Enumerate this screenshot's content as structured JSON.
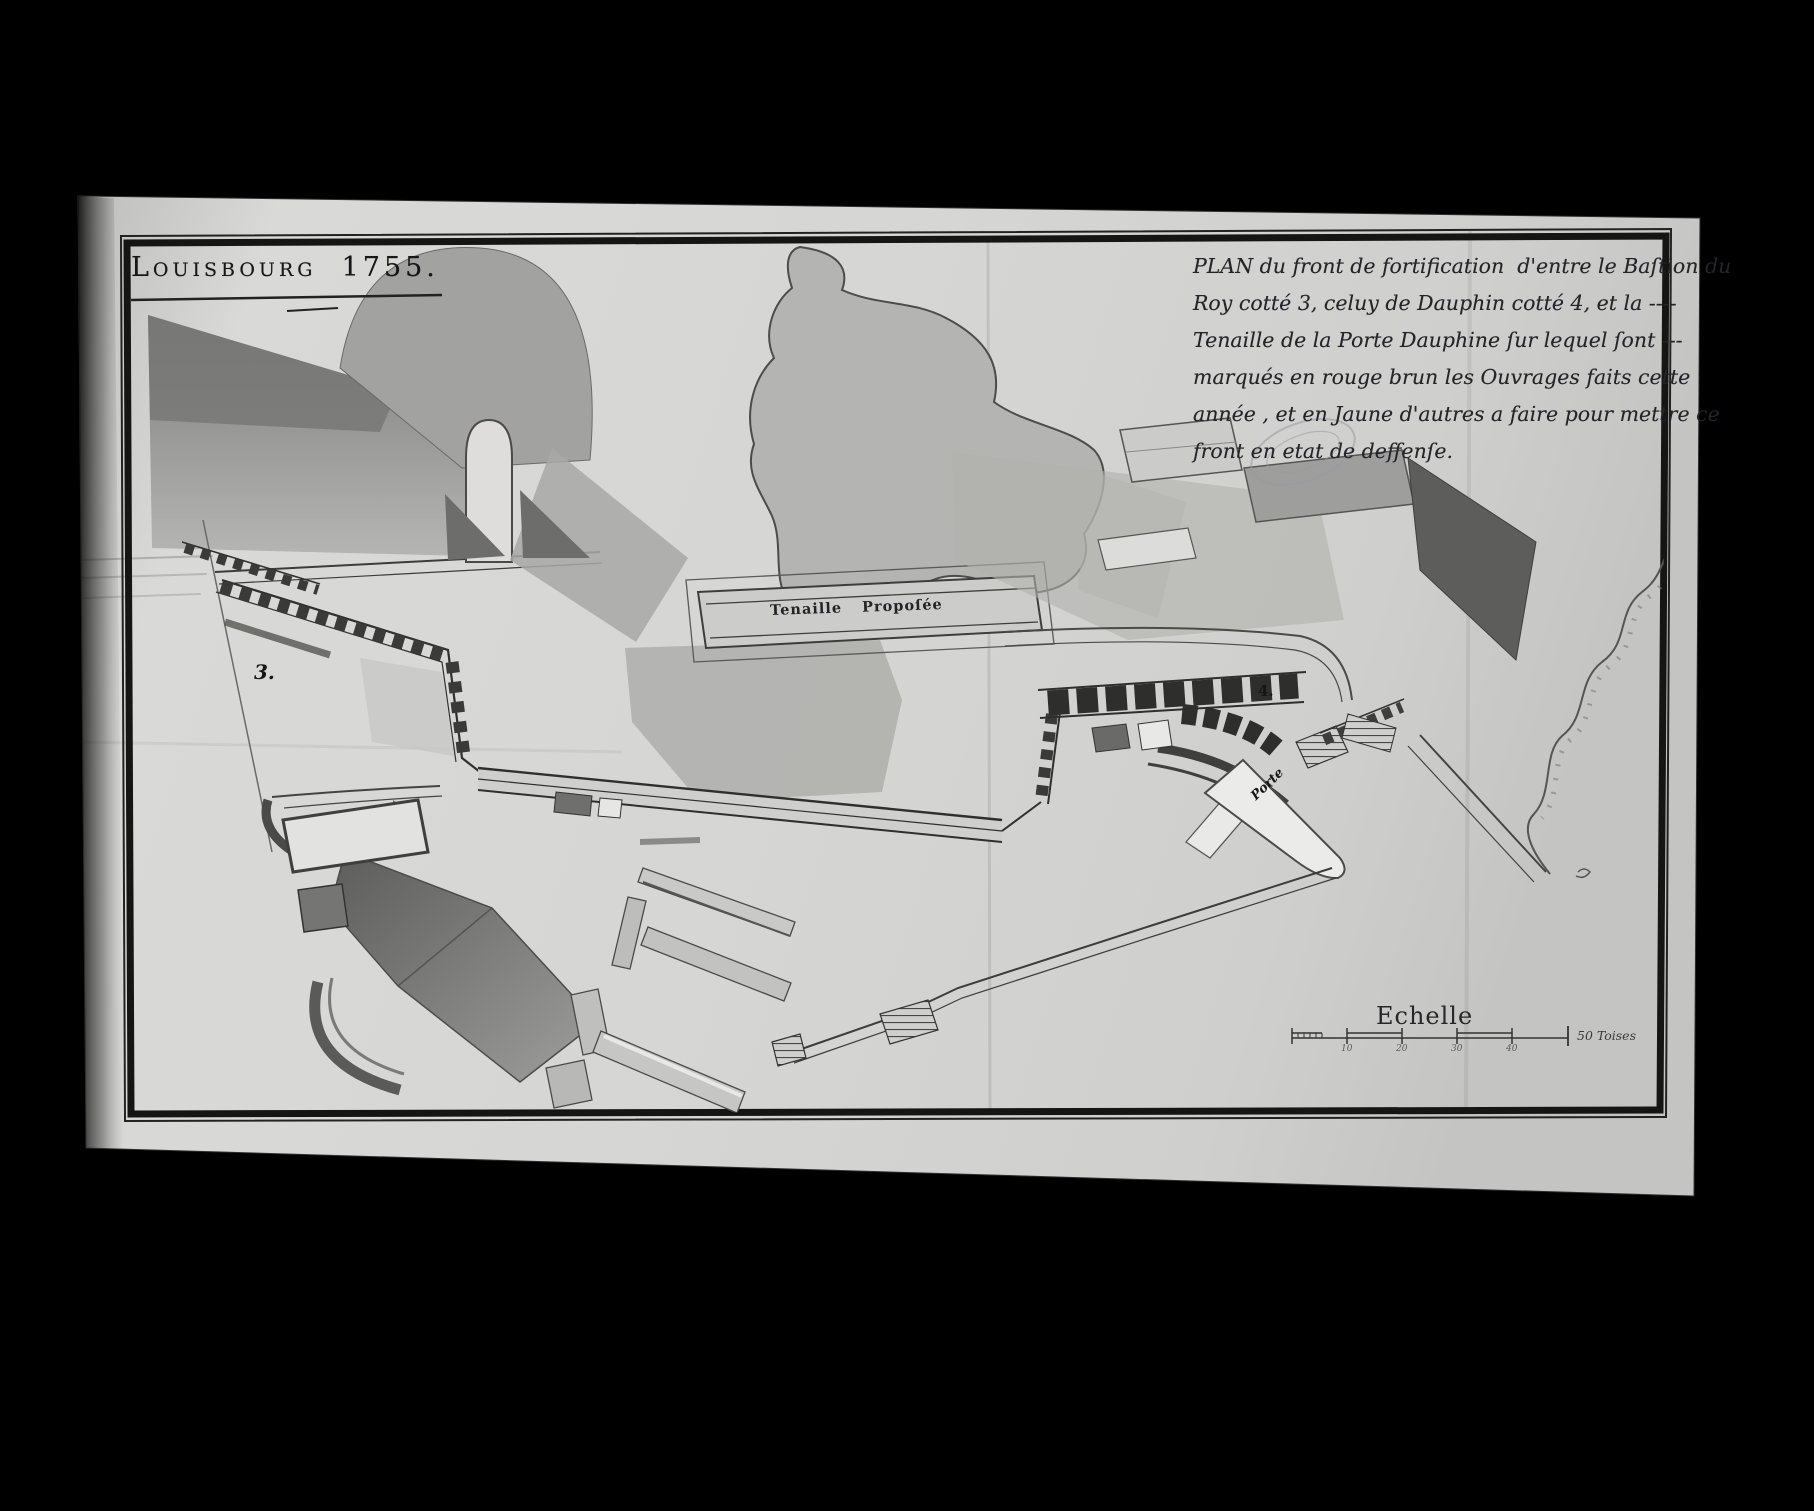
{
  "title_block": {
    "title": "Louisbourg  1755."
  },
  "cartouche": {
    "lines": [
      "PLAN du front de fortification  d'entre le Baſtion du",
      "Roy cotté 3, celuy de Dauphin cotté 4, et la ----",
      "Tenaille de la Porte Dauphine ſur lequel ſont ---",
      "marqués en rouge brun les Ouvrages faits cette",
      "année , et en Jaune d'autres a faire pour mettre ce",
      "front en etat de deffenſe."
    ]
  },
  "map_labels": {
    "tenaille": "Tenaille Propoſée",
    "porte": "Porte",
    "bastion_roy_number": "3.",
    "bastion_dauphin_number": "4."
  },
  "scale_bar": {
    "title": "Echelle",
    "tick_labels": [
      "10",
      "20",
      "30",
      "40"
    ],
    "end_label": "50 Toises"
  },
  "colors": {
    "background": "#000000",
    "paper": "#d7d7d5",
    "ink": "#1d1d20",
    "wash_gray": "#b4b4b2"
  }
}
